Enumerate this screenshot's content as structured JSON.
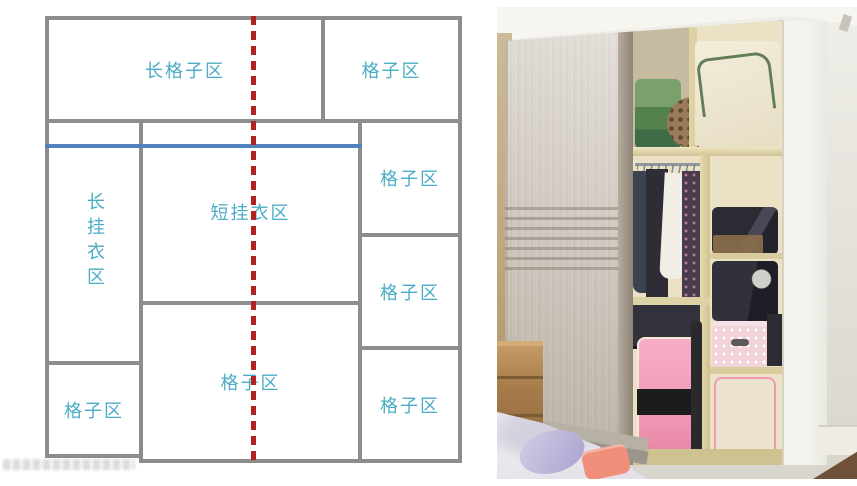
{
  "diagram": {
    "boxes": {
      "long_shelf_top": {
        "label": "长格子区"
      },
      "shelf_top_right": {
        "label": "格子区"
      },
      "long_hang_left": {
        "label": "长挂衣区"
      },
      "short_hang_mid": {
        "label": "短挂衣区"
      },
      "shelf_right_upper": {
        "label": "格子区"
      },
      "shelf_right_middle": {
        "label": "格子区"
      },
      "shelf_bottom_left": {
        "label": "格子区"
      },
      "shelf_bottom_mid": {
        "label": "格子区"
      },
      "shelf_right_lower": {
        "label": "格子区"
      }
    },
    "colors": {
      "box_border": "#8d8d8d",
      "label_text": "#4bacc6",
      "hang_rod_line": "#4f81bd",
      "center_dashed_line": "#b02323"
    }
  },
  "photo": {
    "alt": "wardrobe-photo"
  }
}
